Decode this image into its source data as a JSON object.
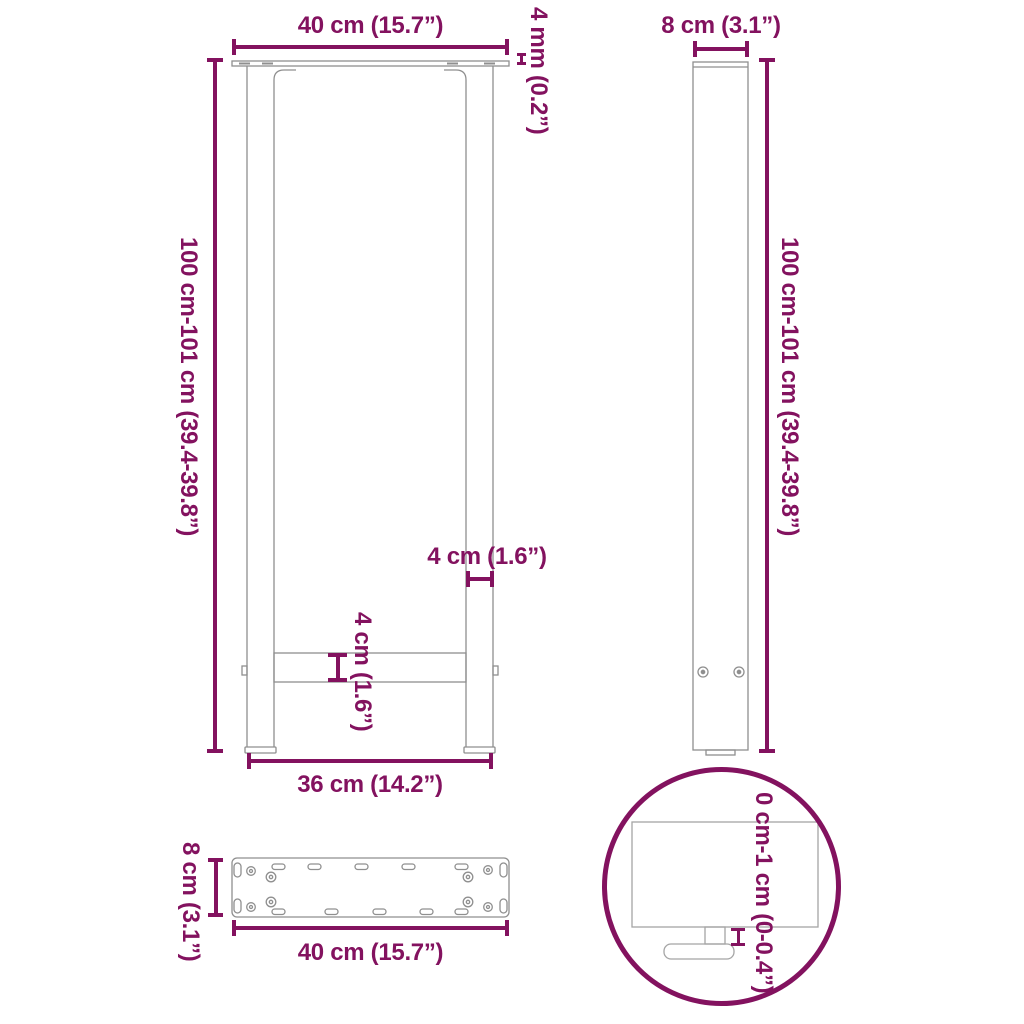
{
  "colors": {
    "dimension_accent": "#83125F",
    "outline_gray": "#8f8f8f",
    "background": "#FFFFFF"
  },
  "front_view": {
    "top_width_label": "40 cm (15.7”)",
    "plate_thickness_label": "4 mm (0.2”)",
    "height_label": "100 cm-101 cm (39.4-39.8”)",
    "leg_width_label": "4 cm (1.6”)",
    "crossbar_height_label": "4 cm (1.6”)",
    "bottom_width_label": "36 cm (14.2”)"
  },
  "side_view": {
    "depth_label": "8 cm (3.1”)",
    "height_label": "100 cm-101 cm (39.4-39.8”)"
  },
  "plate_view": {
    "depth_label": "8 cm (3.1”)",
    "width_label": "40 cm (15.7”)"
  },
  "detail_view": {
    "adjustment_label": "0 cm-1 cm (0-0.4”)"
  }
}
